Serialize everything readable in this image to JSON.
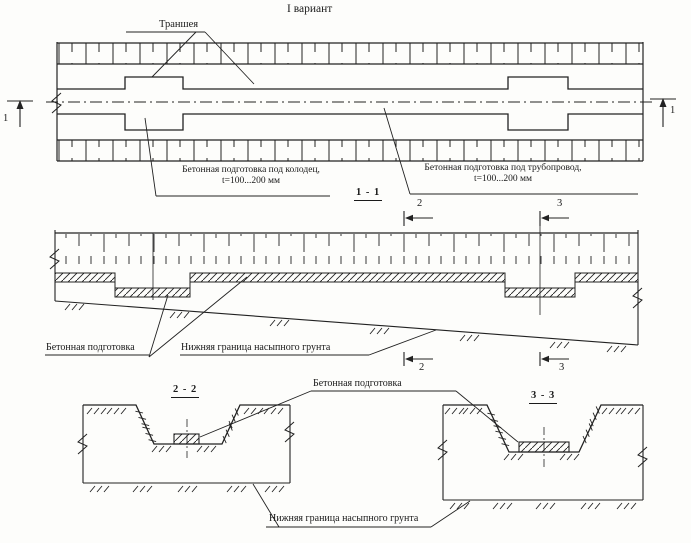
{
  "title": "I вариант",
  "plan": {
    "trench_label": "Траншея",
    "well_prep_line1": "Бетонная подготовка под колодец,",
    "well_prep_line2": "t=100...200 мм",
    "pipe_prep_line1": "Бетонная подготовка под трубопровод,",
    "pipe_prep_line2": "t=100...200 мм",
    "cut_marker_left": "1",
    "cut_marker_right": "1"
  },
  "section_1_1": {
    "title": "1 - 1",
    "cut_marker_2_top": "2",
    "cut_marker_3_top": "3",
    "cut_marker_2_bottom": "2",
    "cut_marker_3_bottom": "3",
    "concrete_prep_label": "Бетонная подготовка",
    "fill_boundary_label": "Нижняя граница насыпного грунта"
  },
  "cross_sections": {
    "title_2_2": "2 - 2",
    "title_3_3": "3 - 3",
    "concrete_prep_label": "Бетонная подготовка",
    "fill_boundary_label": "Нижняя граница насыпного грунта"
  },
  "colors": {
    "line": "#222222",
    "text": "#1a1a1a",
    "background": "#fdfdfb"
  }
}
